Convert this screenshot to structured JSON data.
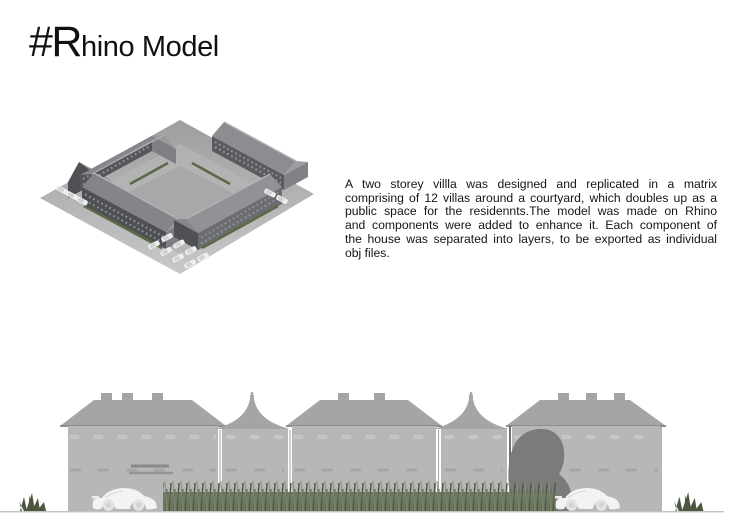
{
  "page": {
    "background": "#ffffff"
  },
  "title": {
    "prefix": "#R",
    "rest": "hino Model"
  },
  "description": {
    "lines": [
      "A two storey villla was designed and replicated in a matrix",
      "comprising of 12 villas around a courtyard, which doubles up as a",
      "public space for the residennts.The model was made on Rhino",
      "and components were added to enhance it. Each component of",
      "the house was separated into layers, to be exported as individual",
      "obj files."
    ]
  },
  "colors": {
    "text": "#111111",
    "elev_facade": "#b7b7b7",
    "elev_roof": "#a5a5a5",
    "tree": "#7b7b7b",
    "grass_dark": "#4c5741",
    "car_body": "#f3f3f3",
    "iso_wall_dark": "#4e5054",
    "iso_wall_medium": "#6b6d71",
    "iso_wall_light": "#7d7f83",
    "iso_roof": "#85878a",
    "iso_ground_dark": "#a0a0a0",
    "iso_ground_light": "#c6c6c6",
    "hedge_green": "#5a6a48"
  }
}
